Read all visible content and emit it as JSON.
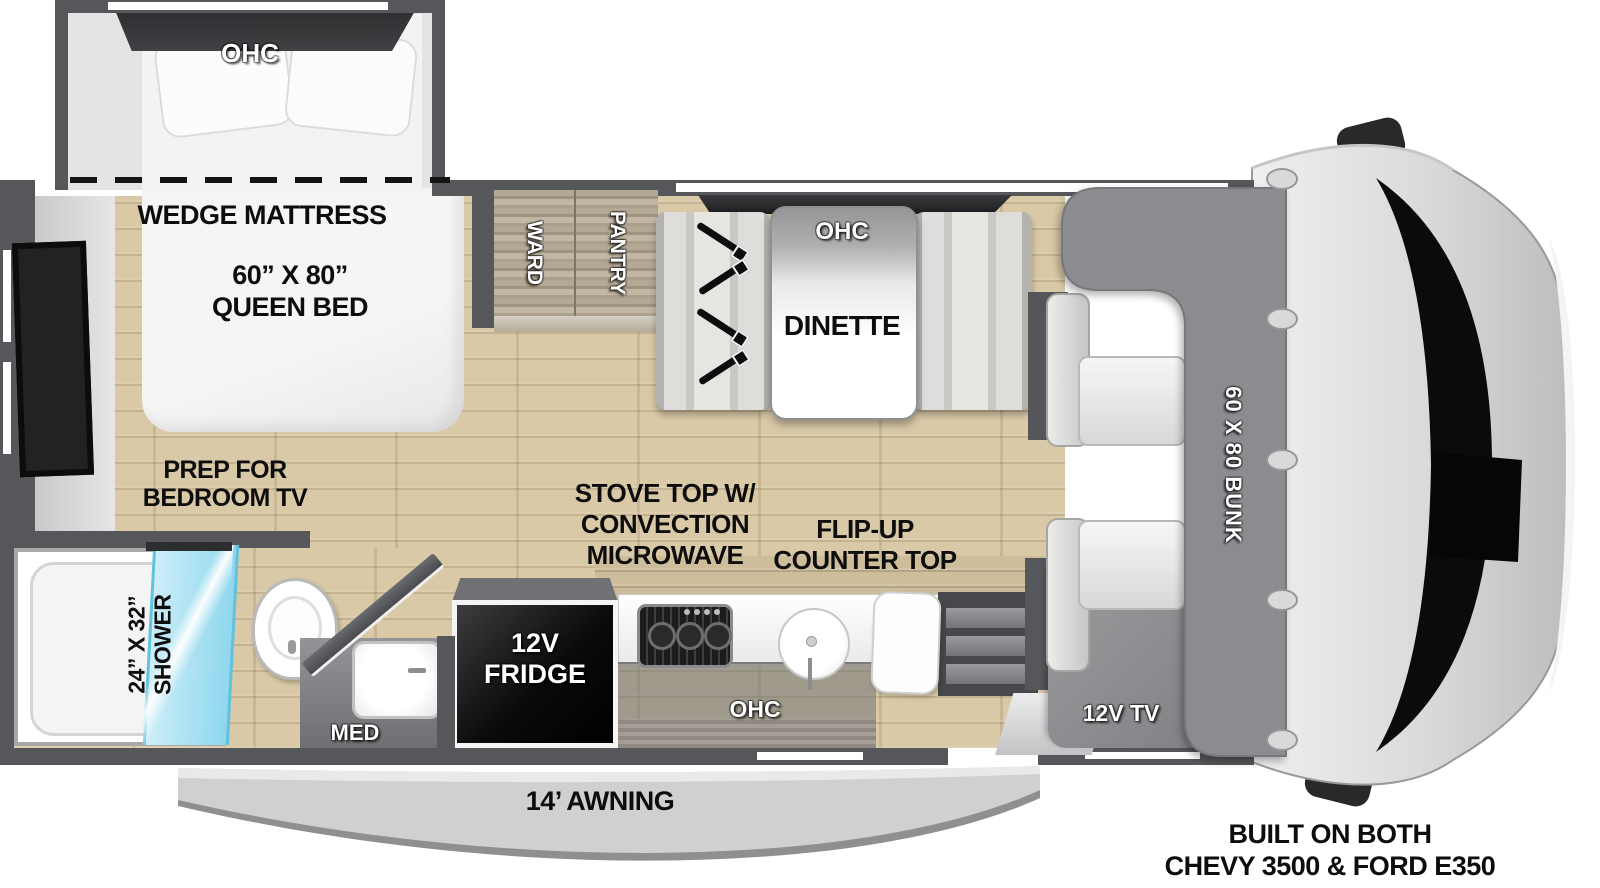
{
  "colors": {
    "wall": "#56575a",
    "floor_wood": "#d9c9a7",
    "bunk_gray": "#8b8c8f",
    "shower_glass": "#9fdcef",
    "cab_body": "#d9dadb",
    "label_black": "#0d0d0d",
    "label_white": "#ffffff"
  },
  "bedroom": {
    "ohc": "OHC",
    "wedge": "WEDGE MATTRESS",
    "bed_size": "60” X 80”",
    "bed_type": "QUEEN BED",
    "tv_prep1": "PREP FOR",
    "tv_prep2": "BEDROOM TV"
  },
  "storage": {
    "ward": "WARD",
    "pantry": "PANTRY"
  },
  "dinette": {
    "ohc": "OHC",
    "label": "DINETTE"
  },
  "bathroom": {
    "shower_size": "24” X 32”",
    "shower": "SHOWER",
    "med": "MED"
  },
  "kitchen": {
    "fridge1": "12V",
    "fridge2": "FRIDGE",
    "ohc": "OHC",
    "stove1": "STOVE TOP W/",
    "stove2": "CONVECTION",
    "stove3": "MICROWAVE",
    "flip1": "FLIP-UP",
    "flip2": "COUNTER TOP"
  },
  "cab": {
    "bunk": "60 X 80 BUNK",
    "tv": "12V TV"
  },
  "exterior": {
    "awning": "14’ AWNING",
    "chassis1": "BUILT ON BOTH",
    "chassis2": "CHEVY 3500 & FORD E350"
  }
}
